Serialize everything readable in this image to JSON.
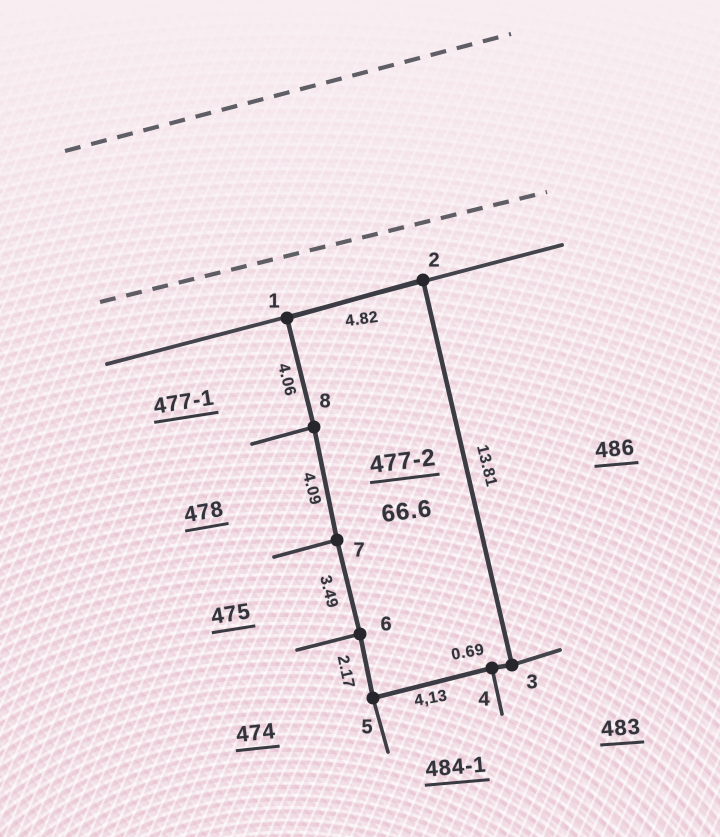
{
  "document": {
    "kind_label": "cadastral parcel sketch",
    "main_parcel": {
      "number": "477-2",
      "area": "66.6"
    }
  },
  "colors": {
    "ink": "#3c3c44",
    "dot": "#26262c",
    "paper_pink": "#f3e2e8",
    "pattern_pink": "#dfa8be",
    "pattern_white": "#ffffff"
  },
  "vertices": [
    {
      "id": "1",
      "x": 287,
      "y": 318,
      "label": {
        "x": 274,
        "y": 302
      }
    },
    {
      "id": "2",
      "x": 423,
      "y": 280,
      "label": {
        "x": 434,
        "y": 261
      }
    },
    {
      "id": "3",
      "x": 512,
      "y": 665,
      "label": {
        "x": 532,
        "y": 683
      }
    },
    {
      "id": "4",
      "x": 492,
      "y": 668,
      "label": {
        "x": 484,
        "y": 700
      }
    },
    {
      "id": "5",
      "x": 373,
      "y": 698,
      "label": {
        "x": 367,
        "y": 728
      }
    },
    {
      "id": "6",
      "x": 360,
      "y": 634,
      "label": {
        "x": 386,
        "y": 625
      }
    },
    {
      "id": "7",
      "x": 337,
      "y": 540,
      "label": {
        "x": 359,
        "y": 551
      }
    },
    {
      "id": "8",
      "x": 314,
      "y": 427,
      "label": {
        "x": 325,
        "y": 402
      }
    }
  ],
  "edges": [
    {
      "from": "1",
      "to": "2",
      "length": "4.82",
      "label": {
        "x": 362,
        "y": 320,
        "rot": -8
      }
    },
    {
      "from": "2",
      "to": "3",
      "length": "13.81",
      "label": {
        "x": 486,
        "y": 466,
        "rot": 76
      }
    },
    {
      "from": "3",
      "to": "4",
      "length": "0.69",
      "label": {
        "x": 468,
        "y": 653,
        "rot": -10
      }
    },
    {
      "from": "4",
      "to": "5",
      "length": "4,13",
      "label": {
        "x": 431,
        "y": 699,
        "rot": -10
      }
    },
    {
      "from": "5",
      "to": "6",
      "length": "2.17",
      "label": {
        "x": 345,
        "y": 672,
        "rot": 78
      }
    },
    {
      "from": "6",
      "to": "7",
      "length": "3.49",
      "label": {
        "x": 328,
        "y": 592,
        "rot": 76
      }
    },
    {
      "from": "7",
      "to": "8",
      "length": "4.09",
      "label": {
        "x": 311,
        "y": 489,
        "rot": 76
      }
    },
    {
      "from": "8",
      "to": "1",
      "length": "4.06",
      "label": {
        "x": 286,
        "y": 380,
        "rot": 76
      }
    }
  ],
  "boundary_lines": [
    {
      "name": "dashed-road-line-upper",
      "x1": 65,
      "y1": 151,
      "x2": 511,
      "y2": 34,
      "style": "dashed"
    },
    {
      "name": "dashed-road-line-lower",
      "x1": 100,
      "y1": 302,
      "x2": 547,
      "y2": 192,
      "style": "dashed"
    },
    {
      "name": "road-edge-through-1-2",
      "x1": 107,
      "y1": 364,
      "x2": 562,
      "y2": 245,
      "style": "solid"
    },
    {
      "name": "road-edge-from-3",
      "x1": 512,
      "y1": 665,
      "x2": 560,
      "y2": 650,
      "style": "solid"
    },
    {
      "name": "boundary-spur-at-8",
      "x1": 314,
      "y1": 427,
      "x2": 252,
      "y2": 444,
      "style": "spur"
    },
    {
      "name": "boundary-spur-at-7",
      "x1": 337,
      "y1": 540,
      "x2": 274,
      "y2": 557,
      "style": "spur"
    },
    {
      "name": "boundary-spur-at-6",
      "x1": 360,
      "y1": 634,
      "x2": 297,
      "y2": 650,
      "style": "spur"
    },
    {
      "name": "boundary-spur-below-5",
      "x1": 373,
      "y1": 698,
      "x2": 388,
      "y2": 752,
      "style": "spur"
    },
    {
      "name": "boundary-spur-below-4",
      "x1": 492,
      "y1": 668,
      "x2": 502,
      "y2": 714,
      "style": "spur"
    }
  ],
  "parcel_labels": [
    {
      "text": "477-1",
      "x": 184,
      "y": 402,
      "rot": -9,
      "underline": true,
      "big": false
    },
    {
      "text": "478",
      "x": 204,
      "y": 512,
      "rot": -10,
      "underline": true,
      "big": false
    },
    {
      "text": "475",
      "x": 231,
      "y": 614,
      "rot": -9,
      "underline": true,
      "big": false
    },
    {
      "text": "474",
      "x": 256,
      "y": 733,
      "rot": -6,
      "underline": true,
      "big": false
    },
    {
      "text": "486",
      "x": 615,
      "y": 449,
      "rot": -5,
      "underline": true,
      "big": false
    },
    {
      "text": "483",
      "x": 621,
      "y": 728,
      "rot": -4,
      "underline": true,
      "big": false
    },
    {
      "text": "484-1",
      "x": 456,
      "y": 767,
      "rot": -5,
      "underline": true,
      "big": false
    },
    {
      "text": "477-2",
      "x": 403,
      "y": 462,
      "rot": -7,
      "underline": true,
      "big": true
    },
    {
      "text": "66.6",
      "x": 407,
      "y": 512,
      "rot": -7,
      "underline": false,
      "big": true
    }
  ]
}
